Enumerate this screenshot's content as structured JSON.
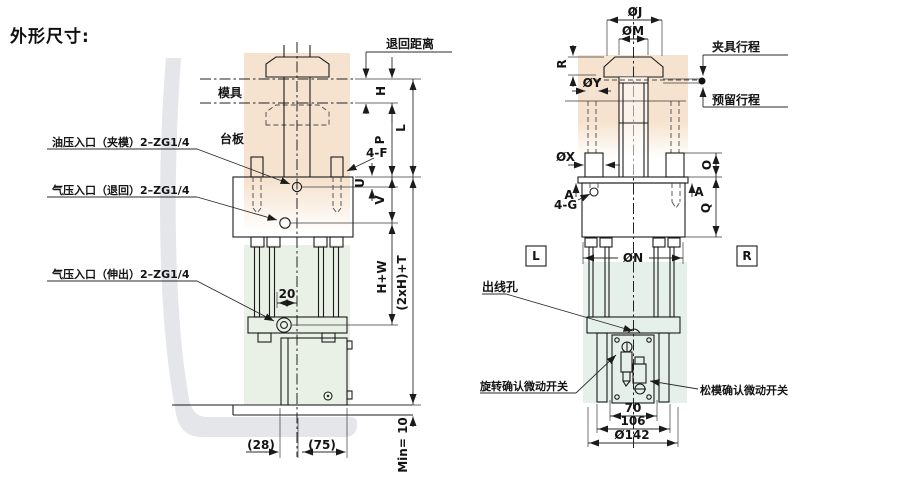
{
  "title": "外形尺寸:",
  "colors": {
    "peach_tint": "#f6e3cf",
    "green_tint_left": "#e9f1e6",
    "green_tint_right": "#e6f0ea",
    "watermark_gray": "#dcdee1",
    "line": "#1b1b1b"
  },
  "left_view": {
    "labels": {
      "mold": "模具",
      "platen": "台板",
      "oil_inlet_clamp": "油压入口（夹模）2–ZG1/4",
      "air_inlet_return": "气压入口（退回）2–ZG1/4",
      "air_inlet_extend": "气压入口（伸出）2–ZG1/4",
      "return_distance": "退回距离"
    },
    "dims": {
      "h": "H",
      "l": "L",
      "p": "P",
      "four_f": "4-F",
      "u": "U",
      "v": "V",
      "h_plus_w": "H+W",
      "two_h_plus_t": "(2xH)+T",
      "rod_offset": "20",
      "base_left": "(28)",
      "base_right": "(75)",
      "min_clearance": "Min= 10"
    }
  },
  "right_view": {
    "labels": {
      "clamp_stroke": "夹具行程",
      "reserve_stroke": "预留行程",
      "wire_outlet": "出线孔",
      "rotation_switch": "旋转确认微动开关",
      "release_switch": "松模确认微动开关",
      "left_marker": "L",
      "right_marker": "R"
    },
    "dims": {
      "oj": "ØJ",
      "om": "ØM",
      "r": "R",
      "oy": "ØY",
      "ox": "ØX",
      "a_left": "A",
      "a_right": "A",
      "four_g": "4-G",
      "o": "O",
      "q": "Q",
      "on": "ØN",
      "w70": "70",
      "w106": "106",
      "w142": "Ø142"
    }
  }
}
